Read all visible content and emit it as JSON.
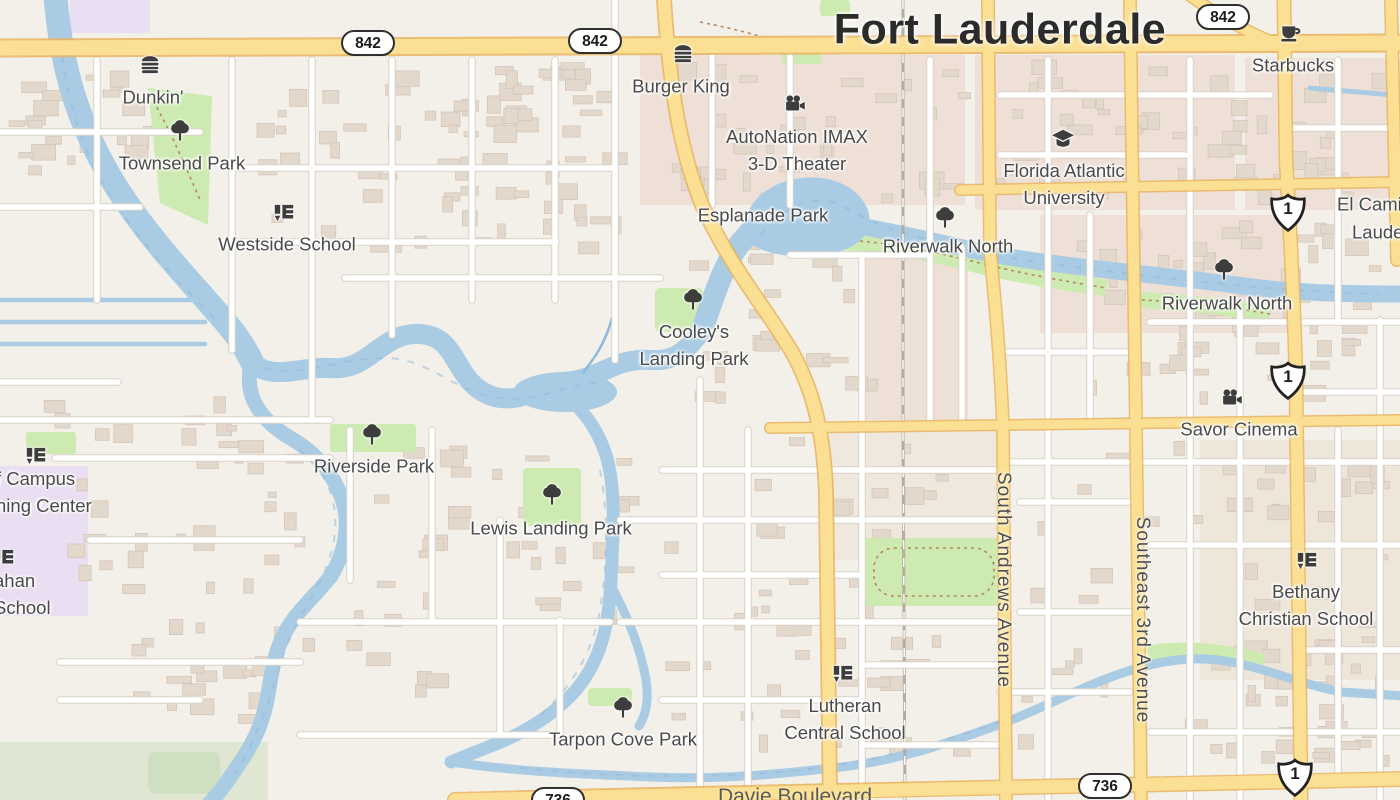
{
  "map": {
    "city_label": "Fort Lauderdale",
    "route_shields": {
      "oval_842": "842",
      "oval_736": "736",
      "us_1": "1"
    },
    "street_labels": {
      "south_andrews": "South Andrews Avenue",
      "southeast_3rd": "Southeast 3rd Avenue",
      "davie": "Davie Boulevard"
    },
    "pois": [
      {
        "id": "dunkin",
        "icon": "fast-food",
        "lines": [
          "Dunkin'"
        ]
      },
      {
        "id": "townsend-park",
        "icon": "tree",
        "lines": [
          "Townsend Park"
        ]
      },
      {
        "id": "westside-school",
        "icon": "school",
        "lines": [
          "Westside School"
        ]
      },
      {
        "id": "burger-king",
        "icon": "fast-food",
        "lines": [
          "Burger King"
        ]
      },
      {
        "id": "autonation-imax",
        "icon": "cinema",
        "lines": [
          "AutoNation IMAX",
          "3-D Theater"
        ]
      },
      {
        "id": "esplanade-park",
        "icon": "none",
        "lines": [
          "Esplanade Park"
        ]
      },
      {
        "id": "riverwalk-north-1",
        "icon": "tree",
        "lines": [
          "Riverwalk North"
        ]
      },
      {
        "id": "florida-atlantic-university",
        "icon": "university",
        "lines": [
          "Florida Atlantic",
          "University"
        ]
      },
      {
        "id": "starbucks",
        "icon": "cafe",
        "lines": [
          "Starbucks"
        ]
      },
      {
        "id": "el-cami-partial",
        "icon": "none",
        "lines": [
          "El Cami"
        ]
      },
      {
        "id": "laude-partial",
        "icon": "none",
        "lines": [
          "Laude"
        ]
      },
      {
        "id": "riverwalk-north-2",
        "icon": "tree",
        "lines": [
          "Riverwalk North"
        ]
      },
      {
        "id": "cooleys-landing-park",
        "icon": "tree",
        "lines": [
          "Cooley's",
          "Landing Park"
        ]
      },
      {
        "id": "savor-cinema",
        "icon": "cinema",
        "lines": [
          "Savor Cinema"
        ]
      },
      {
        "id": "riverside-park",
        "icon": "tree",
        "lines": [
          "Riverside Park"
        ]
      },
      {
        "id": "campus-learning-center-partial",
        "icon": "school",
        "lines": [
          "f Campus",
          "ning Center"
        ]
      },
      {
        "id": "lewis-landing-park",
        "icon": "tree",
        "lines": [
          "Lewis Landing Park"
        ]
      },
      {
        "id": "ahan-school-partial",
        "icon": "school",
        "lines": [
          "ahan",
          "School"
        ]
      },
      {
        "id": "bethany-christian-school",
        "icon": "school",
        "lines": [
          "Bethany",
          "Christian School"
        ]
      },
      {
        "id": "lutheran-central-school",
        "icon": "school",
        "lines": [
          "Lutheran",
          "Central School"
        ]
      },
      {
        "id": "tarpon-cove-park",
        "icon": "tree",
        "lines": [
          "Tarpon Cove Park"
        ]
      }
    ],
    "colors": {
      "water": "#a9cbe3",
      "park": "#cdebb0",
      "road_major": "#fbe093",
      "road_major_casing": "#e9b45e",
      "land": "#f3f0e9",
      "retail_area": "#eee0d7",
      "school_area": "#e9def2",
      "building": "#e3d8cc",
      "label_text": "#4a4a4a",
      "city_text": "#2b2b2b",
      "marsh": "#dfe7d2",
      "railway": "#b4aca2"
    }
  }
}
